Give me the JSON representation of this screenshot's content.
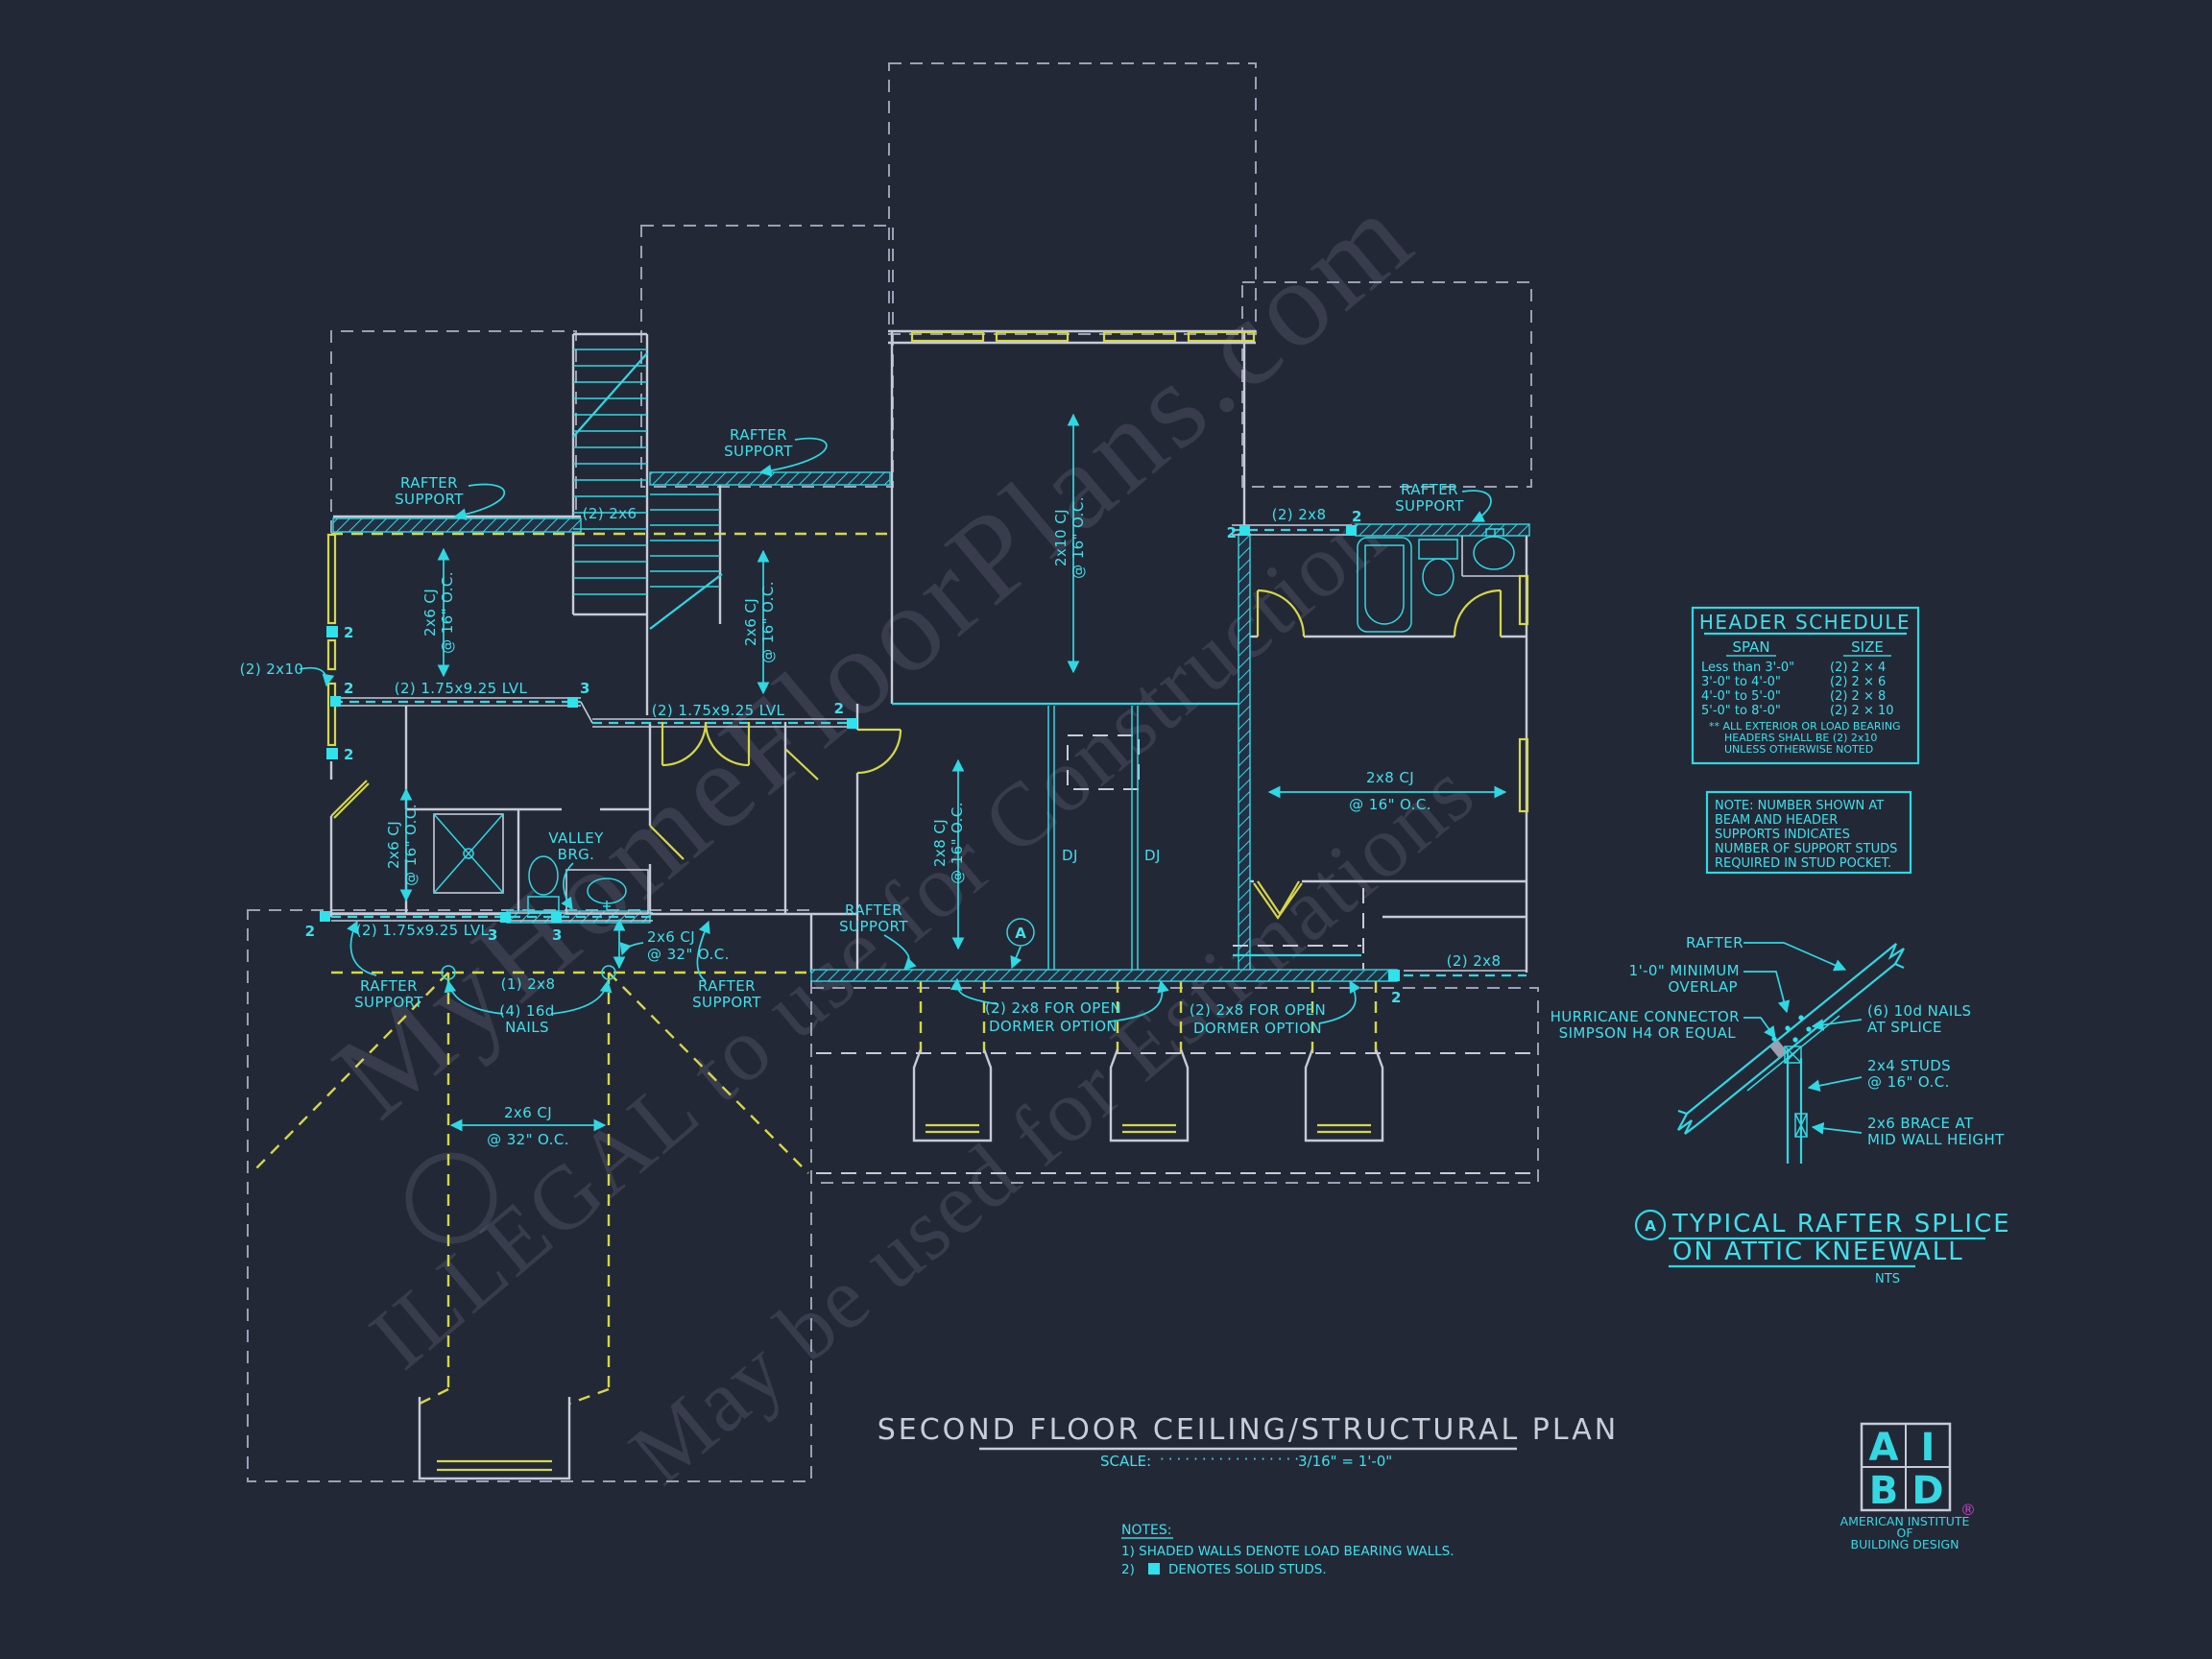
{
  "colors": {
    "background": "#232837",
    "cyan": "#2fd8e2",
    "cyan_text": "#3fe0ea",
    "wall_grey": "#c7cbd8",
    "yellow": "#d5d748",
    "magenta": "#c643c6",
    "watermark": "rgba(198,204,222,0.13)"
  },
  "watermarks": {
    "line1": "MyHomeFloorPlans.com",
    "line2": "ILLEGAL to use for Construction",
    "line3": "May be used for Estimations"
  },
  "plan": {
    "rafter_support": {
      "l1": "RAFTER",
      "l2": "SUPPORT"
    },
    "labels": {
      "two_2x10": "(2) 2x10",
      "two_2x6": "(2) 2x6",
      "two_2x8": "(2) 2x8",
      "one_2x8": "(1) 2x8",
      "lvl": "(2) 1.75x9.25 LVL",
      "nails_l1": "(4) 16d",
      "nails_l2": "NAILS",
      "valley_l1": "VALLEY",
      "valley_l2": "BRG.",
      "dj": "DJ",
      "dormer_l1": "(2) 2x8 FOR OPEN",
      "dormer_l2": "DORMER OPTION",
      "detail_ref": "A"
    },
    "dims": {
      "cj26_16_l1": "2x6 CJ",
      "cj26_16_l2": "@ 16\" O.C.",
      "cj210_16_l1": "2x10 CJ",
      "cj210_16_l2": "@ 16\" O.C.",
      "cj28_16_l1": "2x8 CJ",
      "cj28_16_l2": "@ 16\" O.C.",
      "cj26_32_l1": "2x6 CJ",
      "cj26_32_l2": "@ 32\" O.C."
    },
    "markers": {
      "two": "2",
      "three": "3"
    }
  },
  "detail": {
    "ref": "A",
    "labels": {
      "rafter": "RAFTER",
      "overlap_l1": "1'-0\" MINIMUM",
      "overlap_l2": "OVERLAP",
      "hurricane_l1": "HURRICANE CONNECTOR",
      "hurricane_l2": "SIMPSON H4 OR EQUAL",
      "nails_l1": "(6) 10d NAILS",
      "nails_l2": "AT SPLICE",
      "studs_l1": "2x4 STUDS",
      "studs_l2": "@ 16\" O.C.",
      "brace_l1": "2x6 BRACE AT",
      "brace_l2": "MID WALL HEIGHT"
    },
    "title_l1": "TYPICAL RAFTER SPLICE",
    "title_l2": "ON ATTIC KNEEWALL",
    "scale": "NTS"
  },
  "header_schedule": {
    "title": "HEADER SCHEDULE",
    "col_span": "SPAN",
    "col_size": "SIZE",
    "rows": [
      {
        "span": "Less than 3'-0\"",
        "size": "(2) 2 × 4"
      },
      {
        "span": "3'-0\" to 4'-0\"",
        "size": "(2) 2 × 6"
      },
      {
        "span": "4'-0\" to 5'-0\"",
        "size": "(2) 2 × 8"
      },
      {
        "span": "5'-0\" to 8'-0\"",
        "size": "(2) 2 × 10"
      }
    ],
    "foot_l1": "** ALL EXTERIOR OR LOAD BEARING",
    "foot_l2": "HEADERS SHALL BE (2) 2x10",
    "foot_l3": "UNLESS OTHERWISE NOTED"
  },
  "note_box": {
    "l1": "NOTE: NUMBER SHOWN AT",
    "l2": "BEAM AND HEADER",
    "l3": "SUPPORTS INDICATES",
    "l4": "NUMBER OF SUPPORT STUDS",
    "l5": "REQUIRED IN STUD POCKET."
  },
  "title_block": {
    "title": "SECOND FLOOR CEILING/STRUCTURAL PLAN",
    "scale_label": "SCALE:",
    "scale_dots": "··················",
    "scale_value": "3/16\" = 1'-0\""
  },
  "notes": {
    "heading": "NOTES:",
    "n1": "1) SHADED WALLS DENOTE LOAD BEARING WALLS.",
    "n2_prefix": "2)",
    "n2_text": "DENOTES SOLID STUDS."
  },
  "logo": {
    "a": "A",
    "i": "I",
    "b": "B",
    "d": "D",
    "reg": "®",
    "l1": "AMERICAN INSTITUTE",
    "l2": "OF",
    "l3": "BUILDING DESIGN"
  }
}
